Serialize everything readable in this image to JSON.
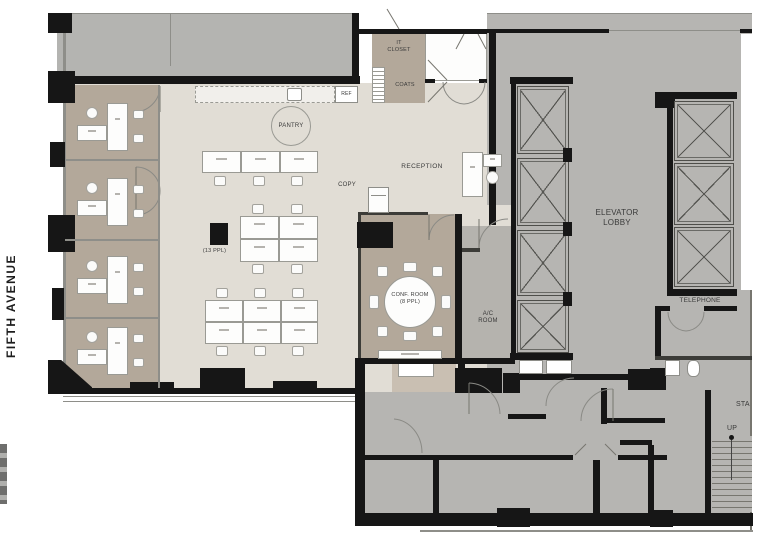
{
  "title": "Office floor plan - Fifth Avenue",
  "street_label": "FIFTH AVENUE",
  "labels": {
    "it_closet": "IT\nCLOSET",
    "coats": "COATS",
    "ref": "REF",
    "pantry": "PANTRY",
    "copy": "COPY",
    "reception": "RECEPTION",
    "open_capacity": "(13 PPL)",
    "conf_room": "CONF. ROOM\n(8 PPL)",
    "ac_room": "A/C\nROOM",
    "elevator_lobby": "ELEVATOR\nLOBBY",
    "telephone": "TELEPHONE",
    "stair": "STA",
    "up": "UP"
  },
  "colors": {
    "wall": "#161616",
    "neighbor_gray": "#b4b4b1",
    "core_gray": "#b6b5b2",
    "office_tan": "#b3a89a",
    "open_area_cream": "#e1ddd5",
    "label_text": "#3a3a3a"
  },
  "rooms_summary": {
    "open_area_seats": 13,
    "conference_seats": 8,
    "private_offices": 4,
    "elevators_left_bank": 4,
    "elevators_right_bank": 3
  }
}
